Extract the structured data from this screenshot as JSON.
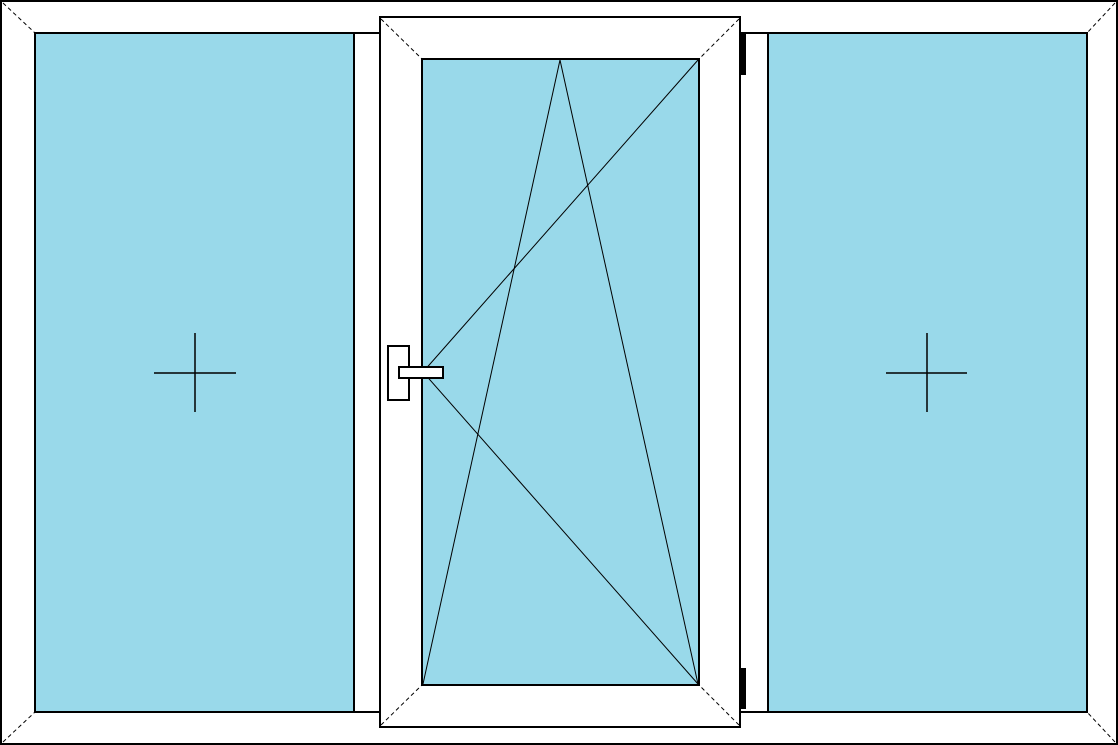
{
  "drawing": {
    "kind": "window-elevation-technical-drawing",
    "canvas": {
      "width": 1118,
      "height": 745
    },
    "colors": {
      "background": "#ffffff",
      "line": "#000000",
      "glass": "#99d9ea",
      "frame_fill": "#ffffff",
      "hinge": "#000000"
    },
    "frame": {
      "outer": {
        "x": 1,
        "y": 1,
        "w": 1116,
        "h": 743
      },
      "inner": {
        "x": 35,
        "y": 33,
        "w": 1052,
        "h": 679
      },
      "miter_joints": [
        [
          3,
          3,
          35,
          33
        ],
        [
          1115,
          3,
          1087,
          33
        ],
        [
          3,
          742,
          35,
          712
        ],
        [
          1115,
          742,
          1087,
          712
        ]
      ]
    },
    "left_panel": {
      "type": "fixed-glazing",
      "glass": {
        "x": 35,
        "y": 33,
        "w": 319,
        "h": 679
      },
      "cross_lines": [
        [
          154,
          373,
          236,
          373
        ],
        [
          195,
          333,
          195,
          412
        ]
      ]
    },
    "right_panel": {
      "type": "fixed-glazing",
      "glass": {
        "x": 768,
        "y": 33,
        "w": 319,
        "h": 679
      },
      "cross_lines": [
        [
          886,
          373,
          967,
          373
        ],
        [
          927,
          333,
          927,
          412
        ]
      ]
    },
    "center_sash": {
      "type": "tilt-and-turn",
      "hinge_side": "right",
      "handle_side": "left",
      "frame": {
        "x": 380,
        "y": 17,
        "w": 360,
        "h": 710
      },
      "glass": {
        "x": 422,
        "y": 59,
        "w": 277,
        "h": 626
      },
      "miter_joints": [
        [
          381,
          19,
          423,
          60
        ],
        [
          739,
          19,
          698,
          60
        ],
        [
          381,
          725,
          423,
          684
        ],
        [
          739,
          725,
          698,
          684
        ]
      ],
      "opening_symbol_lines": [
        [
          423,
          372,
          698,
          60
        ],
        [
          423,
          372,
          698,
          684
        ],
        [
          560,
          60,
          423,
          684
        ],
        [
          560,
          60,
          698,
          684
        ]
      ],
      "handle": {
        "plate": {
          "x": 388,
          "y": 346,
          "w": 21,
          "h": 54
        },
        "grip": {
          "x": 399,
          "y": 367,
          "w": 44,
          "h": 11
        }
      },
      "hinges": [
        {
          "x": 741,
          "y": 33,
          "w": 5,
          "h": 42
        },
        {
          "x": 741,
          "y": 668,
          "w": 5,
          "h": 41
        }
      ]
    }
  }
}
